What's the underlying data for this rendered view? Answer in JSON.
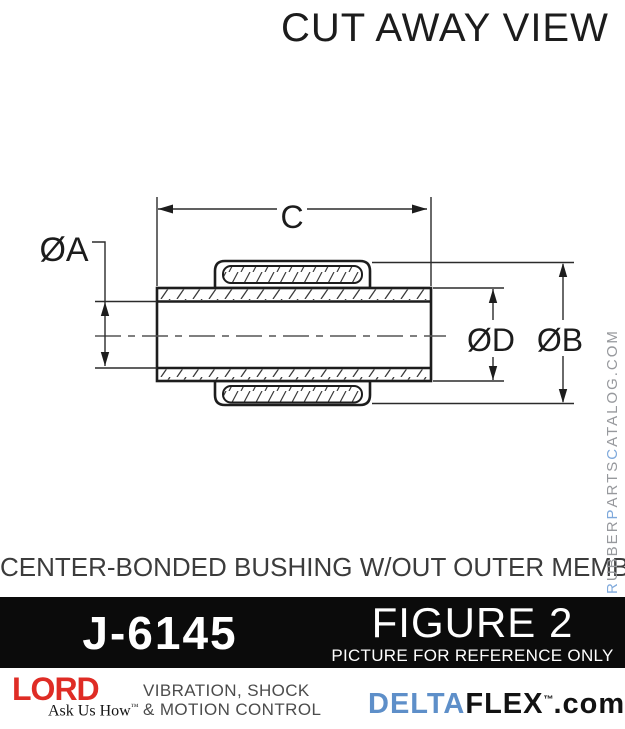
{
  "title": "CUT AWAY VIEW",
  "caption": "CENTER-BONDED BUSHING W/OUT OUTER MEMBER",
  "diagram": {
    "type": "cutaway-cross-section",
    "subject": "center-bonded bushing without outer member",
    "labels": {
      "a": "ØA",
      "b": "ØB",
      "c": "C",
      "d": "ØD"
    },
    "dimensions_meaning": {
      "a": "inner bore diameter",
      "b": "outer rubber diameter",
      "c": "inner member length",
      "d": "inner member outer diameter"
    }
  },
  "figure_bar": {
    "part_number": "J-6145",
    "figure_label": "FIGURE 2",
    "reference_note": "PICTURE FOR REFERENCE ONLY"
  },
  "footer": {
    "lord_logo": "LORD",
    "lord_tagline": "Ask Us How",
    "lord_tm": "™",
    "services_line1": "VIBRATION, SHOCK",
    "services_line2": "& MOTION CONTROL",
    "brand": {
      "delta": "DELTA",
      "flex": "FLEX",
      "tm": "™",
      "domain": ".com"
    }
  },
  "watermark": {
    "segments": [
      {
        "text": "R"
      },
      {
        "text": "UBBER"
      },
      {
        "text": "P"
      },
      {
        "text": "ARTS"
      },
      {
        "text": "C"
      },
      {
        "text": "ATALOG.COM"
      }
    ]
  },
  "colors": {
    "lord_red": "#DF2C25",
    "delta_blue": "#5E8FC9",
    "watermark_grey": "#97999D",
    "watermark_blue": "#7FA9DB",
    "bar_background": "#0B0B0B",
    "line_color": "#1D1D1D"
  }
}
